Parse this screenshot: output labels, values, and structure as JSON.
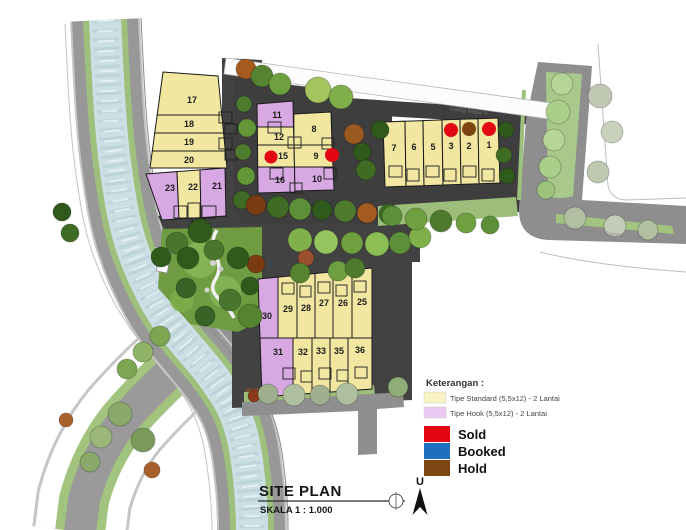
{
  "colors": {
    "standard": "#f1e7a0",
    "hook": "#d8a8e3",
    "legend_standard": "#f8f2c4",
    "legend_hook": "#ecc9f3",
    "sold": "#e30613",
    "booked": "#1e6fbe",
    "hold": "#7d4511"
  },
  "legend": {
    "title": "Keterangan :",
    "types": [
      {
        "label": "Tipe Standard (5,5x12) - 2 Lantai",
        "color_key": "legend_standard"
      },
      {
        "label": "Tipe Hook (5,5x12) - 2 Lantai",
        "color_key": "legend_hook"
      }
    ],
    "statuses": [
      {
        "label": "Sold",
        "color_key": "sold"
      },
      {
        "label": "Booked",
        "color_key": "booked"
      },
      {
        "label": "Hold",
        "color_key": "hold"
      }
    ]
  },
  "titleblock": {
    "title": "SITE PLAN",
    "scale": "SKALA 1 : 1.000",
    "north_label": "U"
  },
  "streets": {
    "gang_maja": "Gang Maja V",
    "jalan_bottom": "Jalan Kasad Indah"
  },
  "lots": [
    {
      "number": "17",
      "type": "standard",
      "status": null
    },
    {
      "number": "18",
      "type": "standard",
      "status": null
    },
    {
      "number": "19",
      "type": "standard",
      "status": null
    },
    {
      "number": "20",
      "type": "standard",
      "status": null
    },
    {
      "number": "23",
      "type": "hook",
      "status": null
    },
    {
      "number": "22",
      "type": "standard",
      "status": null
    },
    {
      "number": "21",
      "type": "hook",
      "status": null
    },
    {
      "number": "11",
      "type": "hook",
      "status": null
    },
    {
      "number": "12",
      "type": "standard",
      "status": null
    },
    {
      "number": "15",
      "type": "standard",
      "status": "sold"
    },
    {
      "number": "16",
      "type": "hook",
      "status": null
    },
    {
      "number": "8",
      "type": "standard",
      "status": null
    },
    {
      "number": "9",
      "type": "standard",
      "status": "sold"
    },
    {
      "number": "10",
      "type": "hook",
      "status": null
    },
    {
      "number": "7",
      "type": "standard",
      "status": null
    },
    {
      "number": "6",
      "type": "standard",
      "status": null
    },
    {
      "number": "5",
      "type": "standard",
      "status": null
    },
    {
      "number": "3",
      "type": "standard",
      "status": "sold"
    },
    {
      "number": "2",
      "type": "standard",
      "status": "hold"
    },
    {
      "number": "1",
      "type": "standard",
      "status": "sold"
    },
    {
      "number": "30",
      "type": "hook",
      "status": null
    },
    {
      "number": "29",
      "type": "standard",
      "status": null
    },
    {
      "number": "28",
      "type": "standard",
      "status": null
    },
    {
      "number": "27",
      "type": "standard",
      "status": null
    },
    {
      "number": "26",
      "type": "standard",
      "status": null
    },
    {
      "number": "25",
      "type": "standard",
      "status": null
    },
    {
      "number": "31",
      "type": "hook",
      "status": null
    },
    {
      "number": "32",
      "type": "standard",
      "status": null
    },
    {
      "number": "33",
      "type": "standard",
      "status": null
    },
    {
      "number": "35",
      "type": "standard",
      "status": null
    },
    {
      "number": "36",
      "type": "standard",
      "status": null
    }
  ]
}
